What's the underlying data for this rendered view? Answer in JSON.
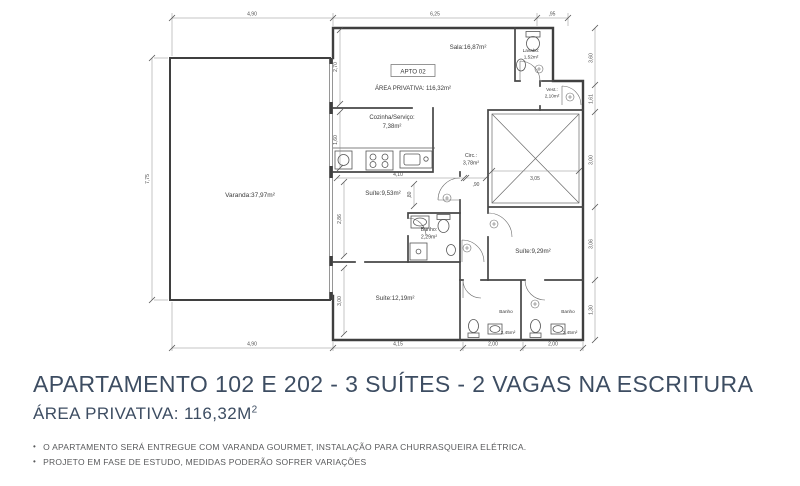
{
  "plan": {
    "apto_label": "APTO 02",
    "area_label": "ÁREA PRIVATIVA: 116,32m²",
    "rooms": {
      "varanda": "Varanda:37,97m²",
      "sala": "Sala:16,87m²",
      "lavabo_1": "Lavabo:",
      "lavabo_2": "1,52m²",
      "vest_1": "Vest.:",
      "vest_2": "2,10m²",
      "cozinha_1": "Cozinha/Serviço:",
      "cozinha_2": "7,38m²",
      "circ_1": "Circ.:",
      "circ_2": "3,78m²",
      "suite_953": "Suíte:9,53m²",
      "banho_suite_1": "Banho:",
      "banho_suite_2": "2,29m²",
      "suite_1219": "Suíte:12,19m²",
      "suite_929": "Suíte:9,29m²",
      "banho_esq_1": "Banho",
      "banho_esq_2": "2,45m²",
      "banho_dir_1": "Banho",
      "banho_dir_2": "2,45m²"
    },
    "dims": {
      "top_1": "4,90",
      "top_2": "6,25",
      "top_3": ",95",
      "bottom_1": "4,90",
      "bottom_2": "4,15",
      "bottom_3": "2,00",
      "bottom_4": "2,00",
      "left_1": "7,75",
      "right_1": "3,60",
      "right_2": "1,61",
      "right_3": "3,00",
      "right_4": "3,06",
      "right_5": "1,30",
      "in_270": "2,70",
      "in_160": "1,60",
      "in_410": "4,10",
      "in_90": ",90",
      "in_305": "3,05",
      "in_286": "2,86",
      "in_300": "3,00",
      "in_80": ",80"
    }
  },
  "footer": {
    "title": "APARTAMENTO 102 E 202 - 3 SUÍTES - 2 VAGAS NA ESCRITURA",
    "area_value": "ÁREA PRIVATIVA: 116,32M",
    "area_sup": "2",
    "bullets": [
      "O APARTAMENTO SERÁ ENTREGUE COM VARANDA GOURMET, INSTALAÇÃO PARA CHURRASQUEIRA ELÉTRICA.",
      "PROJETO EM FASE DE ESTUDO, MEDIDAS PODERÃO SOFRER VARIAÇÕES"
    ]
  },
  "colors": {
    "heading": "#3d4d62",
    "body_text": "#58595b",
    "plan_line": "#3f3f3f"
  }
}
